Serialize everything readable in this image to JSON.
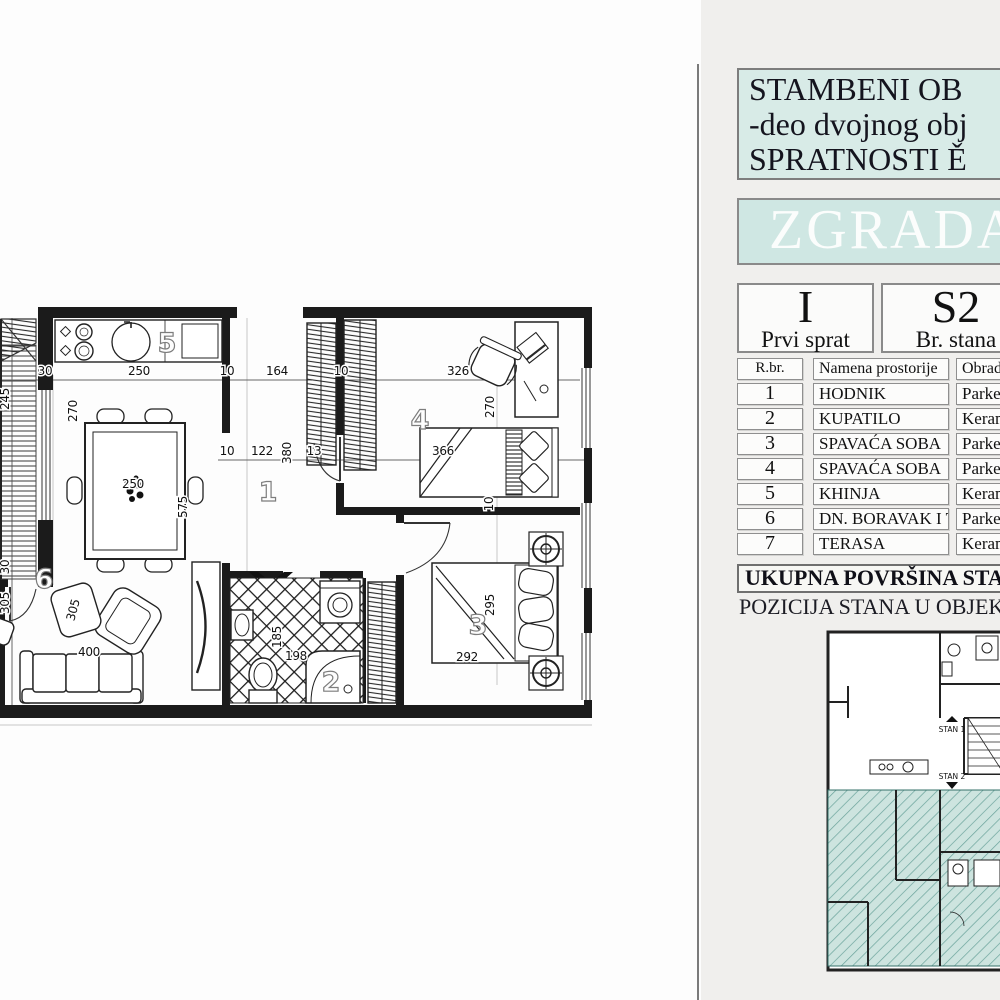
{
  "panel": {
    "title_lines": [
      "STAMBENI OB",
      "-deo dvojnog obj",
      "SPRATNOSTI Ě"
    ],
    "building_label": "ZGRADA",
    "floor": {
      "symbol": "I",
      "caption": "Prvi sprat"
    },
    "unit": {
      "symbol": "S2",
      "caption": "Br. stana"
    },
    "table": {
      "headers": [
        "R.br.",
        "Namena prostorije",
        "Obrad"
      ],
      "rows": [
        {
          "num": "1",
          "name": "HODNIK",
          "finish": "Parket"
        },
        {
          "num": "2",
          "name": "KUPATILO",
          "finish": "Keram"
        },
        {
          "num": "3",
          "name": "SPAVAĆA SOBA",
          "finish": "Parket"
        },
        {
          "num": "4",
          "name": "SPAVAĆA SOBA",
          "finish": "Parket"
        },
        {
          "num": "5",
          "name": "KHINJA",
          "finish": "Keram"
        },
        {
          "num": "6",
          "name": "DN. BORAVAK I TRP.",
          "finish": "Parket"
        },
        {
          "num": "7",
          "name": "TERASA",
          "finish": "Keram"
        }
      ]
    },
    "area_label": "UKUPNA POVRŠINA STAN",
    "position_label": "POZICIJA STANA U OBJEKT",
    "mini_plan_labels": [
      {
        "t": "STAN 1",
        "x": 152,
        "y": 110
      },
      {
        "t": "STAN 2",
        "x": 152,
        "y": 157
      }
    ]
  },
  "plan": {
    "dims": [
      {
        "t": "30",
        "x": 45,
        "y": 90,
        "r": 0
      },
      {
        "t": "250",
        "x": 139,
        "y": 90,
        "r": 0
      },
      {
        "t": "10",
        "x": 227,
        "y": 90,
        "r": 0
      },
      {
        "t": "164",
        "x": 277,
        "y": 90,
        "r": 0
      },
      {
        "t": "10",
        "x": 341,
        "y": 90,
        "r": 0
      },
      {
        "t": "326",
        "x": 458,
        "y": 90,
        "r": 0
      },
      {
        "t": "245",
        "x": 9,
        "y": 114,
        "r": -90
      },
      {
        "t": "270",
        "x": 77,
        "y": 126,
        "r": -90
      },
      {
        "t": "270",
        "x": 494,
        "y": 122,
        "r": -90
      },
      {
        "t": "250",
        "x": 133,
        "y": 203,
        "r": 0
      },
      {
        "t": "10",
        "x": 227,
        "y": 170,
        "r": 0
      },
      {
        "t": "122",
        "x": 262,
        "y": 170,
        "r": 0
      },
      {
        "t": "380",
        "x": 291,
        "y": 168,
        "r": -90
      },
      {
        "t": "13",
        "x": 314,
        "y": 170,
        "r": 0
      },
      {
        "t": "366",
        "x": 443,
        "y": 170,
        "r": 0
      },
      {
        "t": "575",
        "x": 187,
        "y": 222,
        "r": -90
      },
      {
        "t": "30",
        "x": 9,
        "y": 282,
        "r": -90
      },
      {
        "t": "305",
        "x": 9,
        "y": 318,
        "r": -90
      },
      {
        "t": "305",
        "x": 77,
        "y": 326,
        "r": -75
      },
      {
        "t": "400",
        "x": 89,
        "y": 371,
        "r": 0
      },
      {
        "t": "185",
        "x": 281,
        "y": 352,
        "r": -90
      },
      {
        "t": "198",
        "x": 296,
        "y": 375,
        "r": 0
      },
      {
        "t": "10",
        "x": 493,
        "y": 219,
        "r": -90
      },
      {
        "t": "295",
        "x": 494,
        "y": 320,
        "r": -90
      },
      {
        "t": "292",
        "x": 467,
        "y": 376,
        "r": 0
      }
    ],
    "rooms": [
      {
        "t": "5",
        "x": 167,
        "y": 67
      },
      {
        "t": "1",
        "x": 268,
        "y": 216
      },
      {
        "t": "4",
        "x": 420,
        "y": 144
      },
      {
        "t": "3",
        "x": 478,
        "y": 349
      },
      {
        "t": "6",
        "x": 44,
        "y": 303
      },
      {
        "t": "2",
        "x": 331,
        "y": 406
      }
    ]
  },
  "colors": {
    "teal_box": "#d8ebe7",
    "teal_box2": "#cfe7e3",
    "teal_hatch_fill": "#cde4df",
    "teal_hatch_line": "#6aa39b",
    "panel_bg": "#f0efed",
    "wall": "#1b1b1b"
  }
}
